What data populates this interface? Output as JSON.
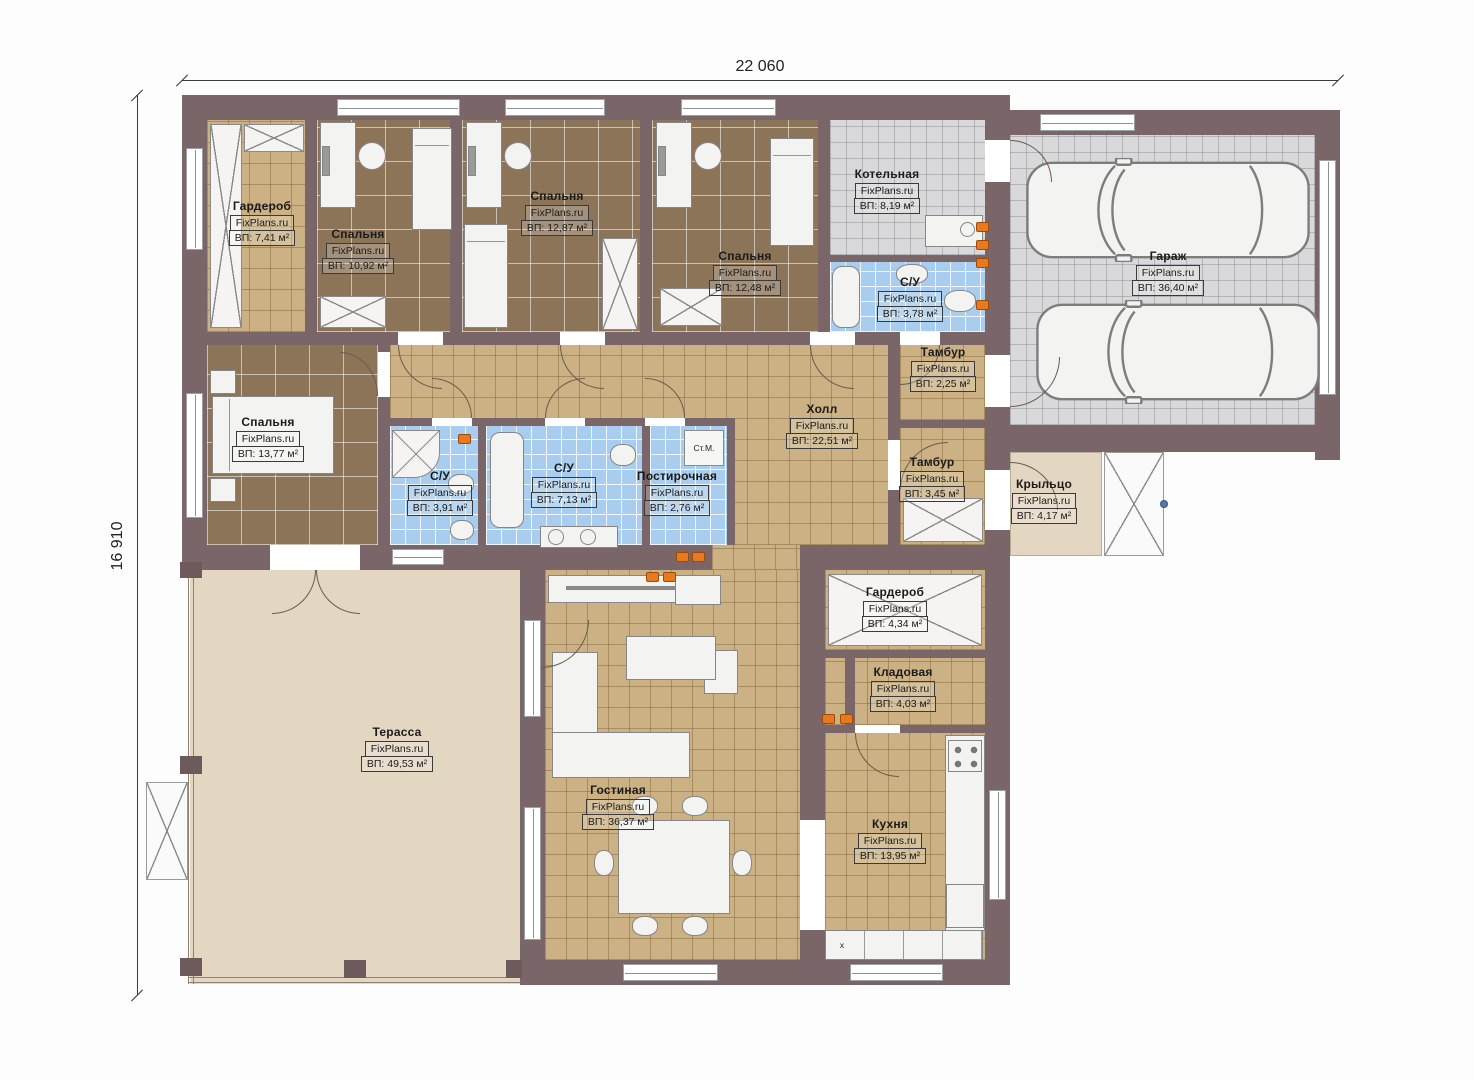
{
  "dimensions": {
    "width_label": "22 060",
    "height_label": "16 910"
  },
  "brand": "FixPlans.ru",
  "rooms": {
    "wardrobe1": {
      "name": "Гардероб",
      "area": "ВП: 7,41 м²"
    },
    "bedroom1": {
      "name": "Спальня",
      "area": "ВП: 10,92 м²"
    },
    "bedroom2": {
      "name": "Спальня",
      "area": "ВП: 12,87 м²"
    },
    "bedroom3": {
      "name": "Спальня",
      "area": "ВП: 12,48 м²"
    },
    "boiler": {
      "name": "Котельная",
      "area": "ВП: 8,19 м²"
    },
    "bath1": {
      "name": "С/У",
      "area": "ВП: 3,78 м²"
    },
    "garage": {
      "name": "Гараж",
      "area": "ВП: 36,40 м²"
    },
    "bedroom4": {
      "name": "Спальня",
      "area": "ВП: 13,77 м²"
    },
    "hall": {
      "name": "Холл",
      "area": "ВП: 22,51 м²"
    },
    "bath2": {
      "name": "С/У",
      "area": "ВП: 3,91 м²"
    },
    "bath3": {
      "name": "С/У",
      "area": "ВП: 7,13 м²"
    },
    "laundry": {
      "name": "Постирочная",
      "area": "ВП: 2,76 м²"
    },
    "vestibule1": {
      "name": "Тамбур",
      "area": "ВП: 2,25 м²"
    },
    "vestibule2": {
      "name": "Тамбур",
      "area": "ВП: 3,45 м²"
    },
    "porch": {
      "name": "Крыльцо",
      "area": "ВП: 4,17 м²"
    },
    "wardrobe2": {
      "name": "Гардероб",
      "area": "ВП: 4,34 м²"
    },
    "pantry": {
      "name": "Кладовая",
      "area": "ВП: 4,03 м²"
    },
    "terrace": {
      "name": "Терасса",
      "area": "ВП: 49,53 м²"
    },
    "living": {
      "name": "Гостиная",
      "area": "ВП: 36,37 м²"
    },
    "kitchen": {
      "name": "Кухня",
      "area": "ВП: 13,95 м²"
    }
  },
  "markers": {
    "washing_machine": "Ст.М.",
    "sink_section": "x"
  },
  "colors": {
    "wall": "#7a6568",
    "floor_wood": "#8c7459",
    "floor_tile_tan": "#cbb183",
    "floor_tile_blue": "#a9cdee",
    "floor_tile_gray": "#d9d9db",
    "terrace": "#e4d7c2",
    "outlet": "#e8791f"
  }
}
